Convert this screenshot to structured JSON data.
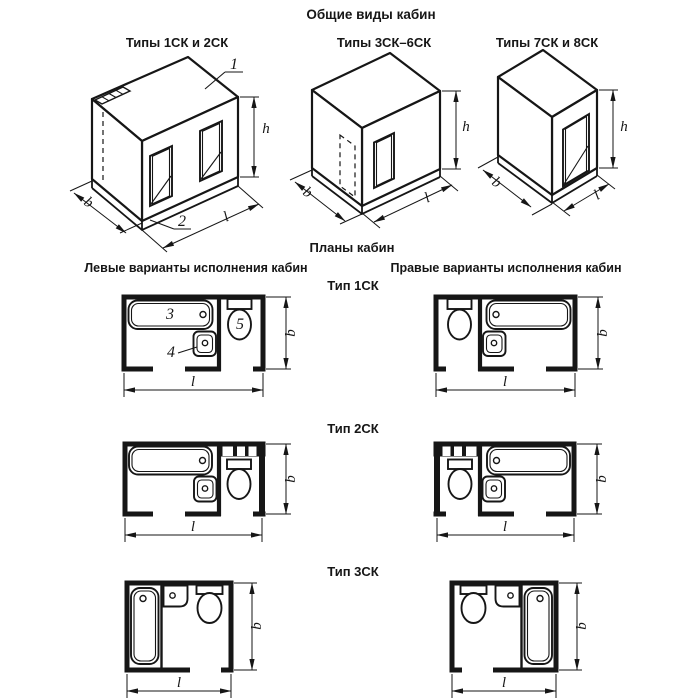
{
  "header": {
    "title": "Общие виды кабин"
  },
  "views": [
    {
      "label": "Типы 1СК и 2СК"
    },
    {
      "label": "Типы 3СК–6СК"
    },
    {
      "label": "Типы 7СК и 8СК"
    }
  ],
  "plans_section": {
    "title": "Планы кабин",
    "left_heading": "Левые варианты исполнения кабин",
    "right_heading": "Правые варианты исполнения кабин",
    "types": [
      {
        "label": "Тип 1СК"
      },
      {
        "label": "Тип 2СК"
      },
      {
        "label": "Тип 3СК"
      }
    ]
  },
  "dim_labels": {
    "height": "h",
    "width": "b",
    "length": "l"
  },
  "callouts": {
    "cabin_top": "1",
    "base": "2",
    "bathtub": "3",
    "washbasin": "4",
    "toilet": "5"
  },
  "colors": {
    "ink": "#161616",
    "paper": "#ffffff"
  }
}
